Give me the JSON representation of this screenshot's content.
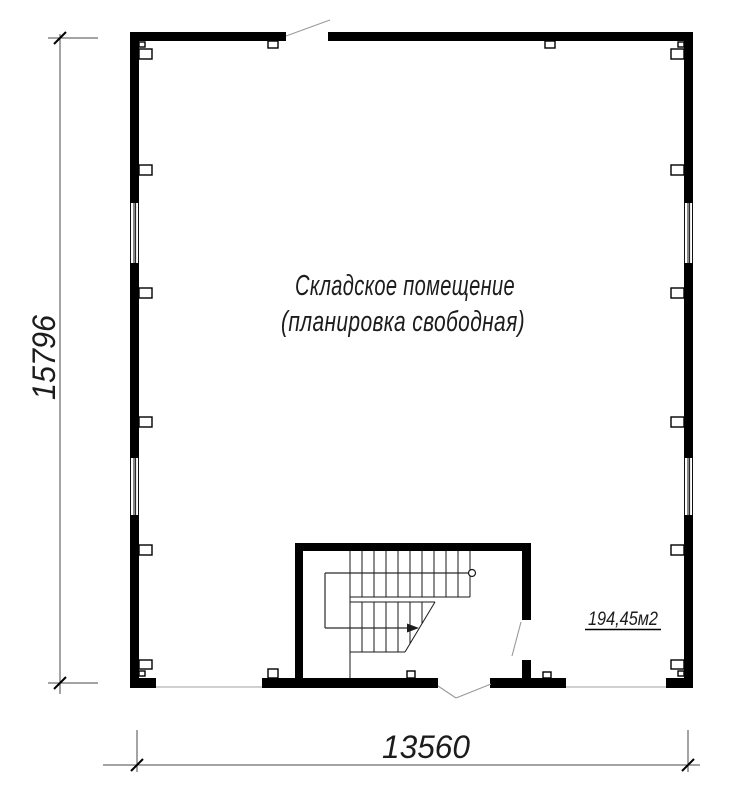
{
  "drawing": {
    "type": "floor-plan",
    "labels": {
      "room_name_line1": "Складское помещение",
      "room_name_line2": "(планировка свободная)",
      "area": "194,45м2"
    },
    "dimensions": {
      "vertical_total": "15796",
      "horizontal_total": "13560"
    },
    "colors": {
      "wall": "#000000",
      "thin_line": "#1a1a1a",
      "door_swing": "#9a9a9a",
      "dimension_line": "#4a4a4a",
      "background": "#ffffff"
    }
  }
}
